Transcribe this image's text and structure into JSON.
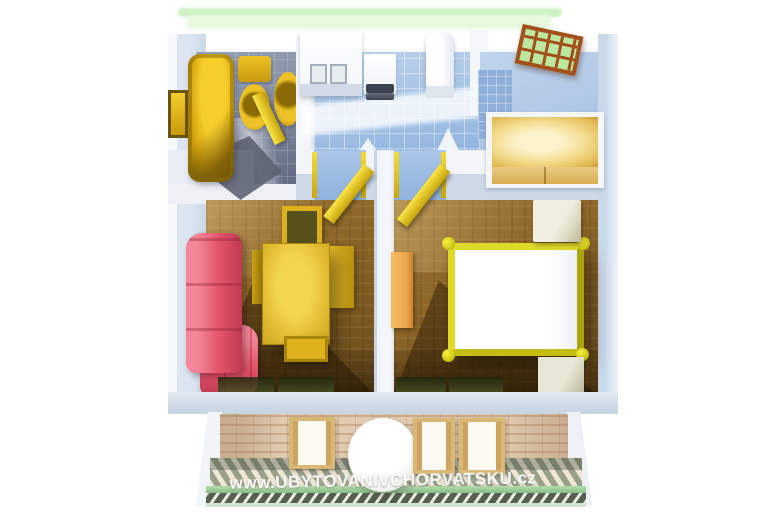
{
  "watermark": {
    "text": "www.UBYTOVANIVCHORVATSKU.cz"
  },
  "palette": {
    "grass-green": "#cff2c4",
    "wall-inner-blue": "#c9d8e8",
    "bath-floor-gray": "#7e879c",
    "kitchen-floor-blue": "#94b6e0",
    "room-floor-brown": "#8a6326",
    "gold-fixture": "#e3bd32",
    "sofa-pink": "#e4556c",
    "bed-frame-yellow": "#dfd92a",
    "wardrobe-tan": "#f4dd92",
    "nightstand-beige": "#d8d4bc",
    "dresser-orange": "#eca74e",
    "door-brown": "#a2511d",
    "door-glass-green": "#bce79e",
    "terrace-brick": "#e2cbb0",
    "railing-green": "#84b686"
  },
  "scene": {
    "type": "3d-rendered apartment floor plan, top view",
    "rooms": [
      {
        "name": "bathroom",
        "items": [
          "bathtub",
          "toilet",
          "bidet",
          "window",
          "door"
        ]
      },
      {
        "name": "kitchen",
        "items": [
          "counter-with-sink",
          "stove",
          "refrigerator"
        ]
      },
      {
        "name": "entry-hall",
        "items": [
          "entrance-door-with-glass-panes",
          "wardrobe"
        ]
      },
      {
        "name": "living-room",
        "items": [
          "corner-sofa",
          "dining-table",
          "four-chairs",
          "door",
          "window"
        ]
      },
      {
        "name": "bedroom",
        "items": [
          "double-bed",
          "two-nightstands",
          "dresser",
          "door",
          "window"
        ]
      },
      {
        "name": "terrace",
        "items": [
          "three-chairs",
          "round-table",
          "railing"
        ]
      }
    ]
  }
}
